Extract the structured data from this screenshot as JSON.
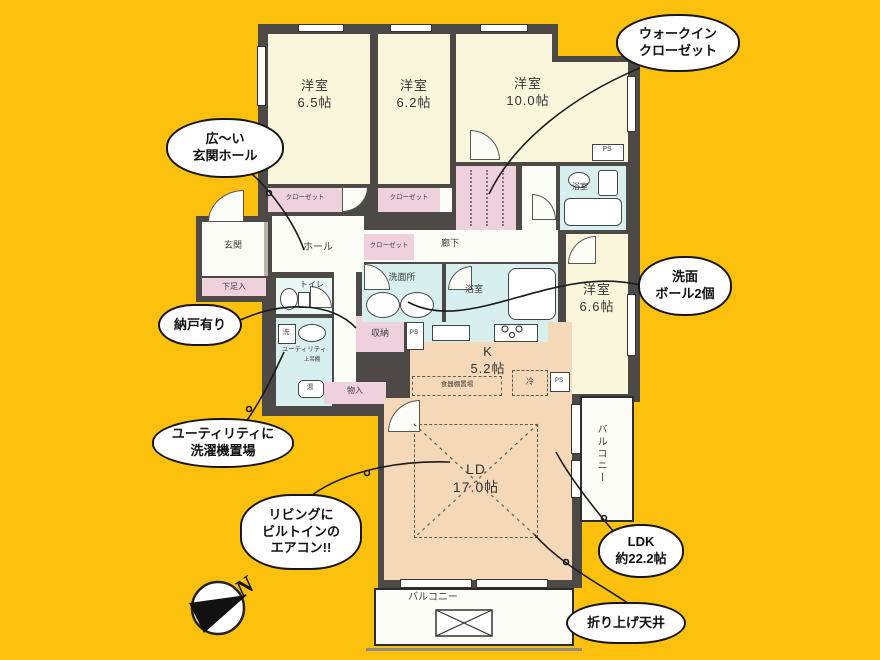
{
  "colors": {
    "background": "#FDC10D",
    "wall": "#4D4947",
    "bedroom_fill": "#FAF6DB",
    "ldk_fill": "#F5D8B7",
    "wet_area_fill": "#D7EFEE",
    "closet_fill": "#EFD1DD",
    "outline": "#1B1B1B"
  },
  "rooms": {
    "bedroom1": {
      "name": "洋室",
      "size": "6.5帖"
    },
    "bedroom2": {
      "name": "洋室",
      "size": "6.2帖"
    },
    "bedroom3": {
      "name": "洋室",
      "size": "10.0帖"
    },
    "bedroom4": {
      "name": "洋室",
      "size": "6.6帖"
    },
    "living_dining": {
      "name": "LD",
      "size": "17.0帖"
    },
    "kitchen": {
      "name": "K",
      "size": "5.2帖"
    }
  },
  "labels": {
    "entrance": "玄関",
    "shoe_box": "下足入",
    "hall": "ホール",
    "corridor": "廊下",
    "toilet": "トイレ",
    "washroom": "洗面所",
    "bath_center": "浴室",
    "bath_top": "浴室",
    "storage": "収納",
    "closet_bed1": "クローゼット",
    "closet_bed2": "クローゼット",
    "closet_hall": "クローゼット",
    "monoire": "物入",
    "utility": "ユーティリティ",
    "washer": "洗",
    "upper_shelf": "上吊棚",
    "water_heater": "湯",
    "ps_top": "PS",
    "ps_kitchen": "PS",
    "ps_right": "PS",
    "fridge": "冷",
    "dish_shelf": "食器棚置場",
    "balcony_right": "バルコニー",
    "balcony_bottom": "バルコニー"
  },
  "callouts": {
    "walk_in_closet": {
      "lines": [
        "ウォークイン",
        "クローゼット"
      ]
    },
    "entrance_hall": {
      "lines": [
        "広〜い",
        "玄関ホール"
      ]
    },
    "wash_bowls": {
      "lines": [
        "洗面",
        "ボール2個"
      ]
    },
    "storage_room": {
      "lines": [
        "納戸有り"
      ]
    },
    "utility_washer": {
      "lines": [
        "ユーティリティに",
        "洗濯機置場"
      ]
    },
    "built_in_aircon": {
      "lines": [
        "リビングに",
        "ビルトインの",
        "エアコン!!"
      ]
    },
    "ldk_area": {
      "lines": [
        "LDK",
        "約22.2帖"
      ]
    },
    "raised_ceiling": {
      "lines": [
        "折り上げ天井"
      ]
    }
  },
  "compass": {
    "north": "N"
  }
}
